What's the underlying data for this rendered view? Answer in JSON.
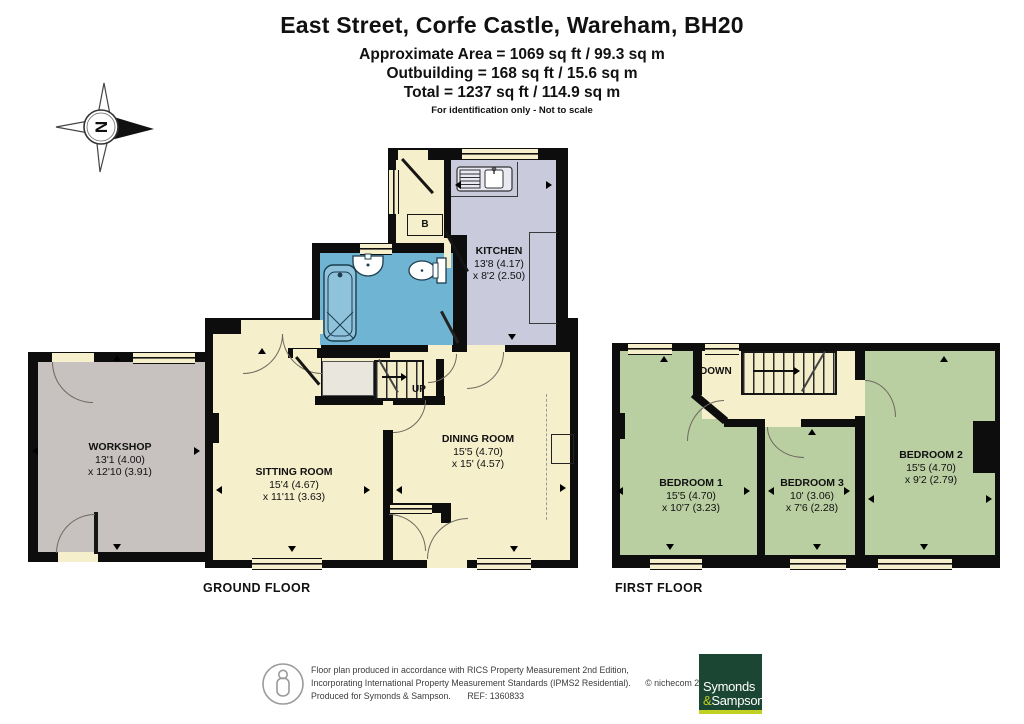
{
  "header": {
    "title": "East Street, Corfe Castle, Wareham, BH20",
    "area_line1": "Approximate Area = 1069 sq ft / 99.3 sq m",
    "area_line2": "Outbuilding = 168 sq ft / 15.6 sq m",
    "area_line3": "Total = 1237 sq ft / 114.9 sq m",
    "disclaimer": "For identification only - Not to scale"
  },
  "compass": {
    "north_label": "N"
  },
  "ground_floor": {
    "label": "GROUND FLOOR",
    "stairs_label": "UP",
    "boiler_label": "B",
    "workshop": {
      "name": "WORKSHOP",
      "dim1": "13'1 (4.00)",
      "dim2": "x 12'10 (3.91)"
    },
    "sitting_room": {
      "name": "SITTING ROOM",
      "dim1": "15'4 (4.67)",
      "dim2": "x 11'11 (3.63)"
    },
    "dining_room": {
      "name": "DINING ROOM",
      "dim1": "15'5 (4.70)",
      "dim2": "x 15' (4.57)"
    },
    "kitchen": {
      "name": "KITCHEN",
      "dim1": "13'8 (4.17)",
      "dim2": "x 8'2 (2.50)"
    }
  },
  "first_floor": {
    "label": "FIRST FLOOR",
    "stairs_label": "DOWN",
    "bedroom1": {
      "name": "BEDROOM 1",
      "dim1": "15'5 (4.70)",
      "dim2": "x 10'7 (3.23)"
    },
    "bedroom3": {
      "name": "BEDROOM 3",
      "dim1": "10' (3.06)",
      "dim2": "x 7'6 (2.28)"
    },
    "bedroom2": {
      "name": "BEDROOM 2",
      "dim1": "15'5 (4.70)",
      "dim2": "x 9'2 (2.79)"
    }
  },
  "footer": {
    "line1": "Floor plan produced in accordance with RICS Property Measurement 2nd Edition,",
    "line2": "Incorporating International Property Measurement Standards (IPMS2 Residential).",
    "copyright": "© nichecom 2025.",
    "line3": "Produced for Symonds & Sampson.",
    "ref": "REF: 1360833",
    "logo": {
      "word1": "Symonds",
      "amp": "&",
      "word2": "Sampson"
    }
  },
  "colors": {
    "wall": "#0d0d0d",
    "cream": "#f6efcc",
    "workshop_grey": "#c7c1c0",
    "kitchen_lilac": "#c9cadb",
    "bathroom_blue": "#70b4d4",
    "bedroom_green": "#b9cfa2",
    "logo_green": "#1c4634",
    "logo_lime": "#c2d021"
  }
}
